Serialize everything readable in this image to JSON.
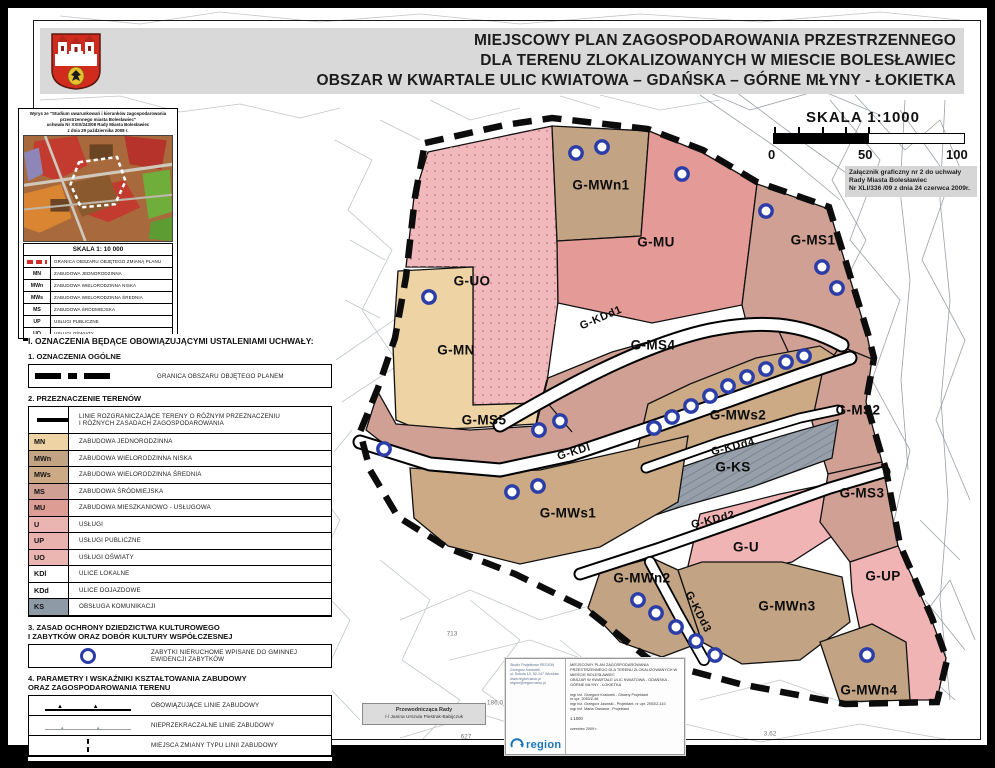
{
  "header": {
    "title_line1": "MIEJSCOWY PLAN ZAGOSPODAROWANIA PRZESTRZENNEGO",
    "title_line2": "DLA TERENU ZLOKALIZOWANYCH W MIESCIE BOLESŁAWIEC",
    "title_line3": "OBSZAR W KWARTALE ULIC KWIATOWA – GDAŃSKA – GÓRNE MŁYNY - ŁOKIETKA"
  },
  "scalebar": {
    "label": "SKALA 1:1000",
    "tick0": "0",
    "tick50": "50",
    "tick100": "100"
  },
  "attachment": {
    "line1": "Załącznik graficzny nr 2 do uchwały",
    "line2": "Rady Miasta Bolesławiec",
    "line3": "Nr XLI/336 /09 z dnia 24 czerwca 2009r."
  },
  "inset": {
    "header_lines": [
      "Wyrys ze \"Studium uwarunkowań i kierunków zagospodarowania",
      "przestrzennego  miasta Bolesławiec\"",
      "uchwała Nr XXIX/243/08 Rady Miasta Bolesławiec",
      "z dnia 29 października 2008 r."
    ],
    "scale_label": "SKALA 1: 10 000",
    "granica_label": "GRANICA OBSZARU OBJĘTEGO ZMIANĄ PLANU",
    "rows": [
      {
        "code": "MN",
        "label": "ZABUDOWA JEDNORODZINNA"
      },
      {
        "code": "MWn",
        "label": "ZABUDOWA WIELORODZINNA NISKA"
      },
      {
        "code": "MWs",
        "label": "ZABUDOWA WIELORODZINNA ŚREDNIA"
      },
      {
        "code": "MS",
        "label": "ZABUDOWA ŚRÓDMIEJSKA"
      },
      {
        "code": "UP",
        "label": "USŁUGI PUBLICZNE"
      },
      {
        "code": "UO",
        "label": "USŁUGI OŚWIATY"
      }
    ]
  },
  "legend": {
    "heading": "I. OZNACZENIA BĘDĄCE OBOWIĄZUJĄCYMI USTALENIAMI UCHWAŁY:",
    "s1": {
      "title": "1. OZNACZENIA OGÓLNE",
      "granica_label": "GRANICA OBSZARU OBJĘTEGO PLANEM"
    },
    "s2": {
      "title": "2. PRZEZNACZENIE TERENÓW",
      "line_row_l1": "LINIE ROZGRANICZAJĄCE TERENY O RÓŻNYM PRZEZNACZENIU",
      "line_row_l2": "I RÓŻNYCH ZASADACH ZAGOSPODAROWANIA",
      "zones": [
        {
          "code": "MN",
          "label": "ZABUDOWA JEDNORODZINNA",
          "color": "#eed3a4"
        },
        {
          "code": "MWn",
          "label": "ZABUDOWA WIELORODZINNA NISKA",
          "color": "#c2a485"
        },
        {
          "code": "MWs",
          "label": "ZABUDOWA WIELORODZINNA ŚREDNIA",
          "color": "#cbaa85"
        },
        {
          "code": "MS",
          "label": "ZABUDOWA ŚRÓDMIEJSKA",
          "color": "#d0a095"
        },
        {
          "code": "MU",
          "label": "ZABUDOWA MIESZKANIOWO - USŁUGOWA",
          "color": "#dd9d95"
        },
        {
          "code": "U",
          "label": "USŁUGI",
          "color": "#eab5b1"
        },
        {
          "code": "UP",
          "label": "USŁUGI PUBLICZNE",
          "color": "#e8b2ae"
        },
        {
          "code": "UO",
          "label": "USŁUGI OŚWIATY",
          "color": "#ebb6b2"
        },
        {
          "code": "KDl",
          "label": "ULICE LOKALNE",
          "color": "#ffffff"
        },
        {
          "code": "KDd",
          "label": "ULICE DOJAZDOWE",
          "color": "#ffffff"
        },
        {
          "code": "KS",
          "label": "OBSŁUGA KOMUNIKACJI",
          "color": "#8e9aa6"
        }
      ]
    },
    "s3": {
      "title_l1": "3. ZASAD OCHRONY DZIEDZICTWA KULTUROWEGO",
      "title_l2": "I ZABYTKÓW ORAZ DOBÓR KULTURY WSPÓŁCZESNEJ",
      "monument_label": "ZABYTKI NIERUCHOME WPISANE DO GMINNEJ EWIDENCJI ZABYTKÓW"
    },
    "s4": {
      "title_l1": "4. PARAMETRY I WSKAŹNIKI KSZTAŁTOWANIA ZABUDOWY",
      "title_l2": "ORAZ ZAGOSPODAROWANIA TERENU",
      "rows": [
        {
          "sym": "obligatory-building-line",
          "label": "OBOWIĄZUJĄCE LINIE ZABUDOWY"
        },
        {
          "sym": "max-building-line",
          "label": "NIEPRZEKRACZALNE LINIE ZABUDOWY"
        },
        {
          "sym": "line-type-change",
          "label": "MIEJSCA ZMIANY TYPU LINII ZABUDOWY"
        }
      ]
    }
  },
  "map": {
    "zones": [
      {
        "id": "G-UO",
        "x": 472,
        "y": 281
      },
      {
        "id": "G-MWn1",
        "x": 601,
        "y": 185
      },
      {
        "id": "G-MU",
        "x": 656,
        "y": 242
      },
      {
        "id": "G-MS1",
        "x": 813,
        "y": 240
      },
      {
        "id": "G-MN",
        "x": 456,
        "y": 350
      },
      {
        "id": "G-KDd1",
        "x": 601,
        "y": 318,
        "rot": -23,
        "cls": "road"
      },
      {
        "id": "G-MS4",
        "x": 653,
        "y": 345
      },
      {
        "id": "G-MS5",
        "x": 484,
        "y": 420
      },
      {
        "id": "G-MWs2",
        "x": 738,
        "y": 415
      },
      {
        "id": "G-MS2",
        "x": 858,
        "y": 410
      },
      {
        "id": "G-KDl",
        "x": 574,
        "y": 452,
        "rot": -17,
        "cls": "road"
      },
      {
        "id": "G-KDd4",
        "x": 733,
        "y": 447,
        "rot": -14,
        "cls": "road"
      },
      {
        "id": "G-KS",
        "x": 733,
        "y": 467
      },
      {
        "id": "G-MS3",
        "x": 862,
        "y": 493
      },
      {
        "id": "G-MWs1",
        "x": 568,
        "y": 513
      },
      {
        "id": "G-KDd2",
        "x": 713,
        "y": 520,
        "rot": -14,
        "cls": "road"
      },
      {
        "id": "G-U",
        "x": 746,
        "y": 547
      },
      {
        "id": "G-MWn2",
        "x": 642,
        "y": 578
      },
      {
        "id": "G-KDd3",
        "x": 698,
        "y": 612,
        "rot": 63,
        "cls": "road"
      },
      {
        "id": "G-MWn3",
        "x": 787,
        "y": 606
      },
      {
        "id": "G-UP",
        "x": 883,
        "y": 576
      },
      {
        "id": "G-MWn4",
        "x": 869,
        "y": 690
      }
    ],
    "monuments": [
      [
        576,
        153
      ],
      [
        602,
        147
      ],
      [
        682,
        174
      ],
      [
        766,
        211
      ],
      [
        822,
        267
      ],
      [
        837,
        288
      ],
      [
        429,
        297
      ],
      [
        384,
        449
      ],
      [
        539,
        430
      ],
      [
        560,
        421
      ],
      [
        512,
        492
      ],
      [
        538,
        486
      ],
      [
        654,
        428
      ],
      [
        672,
        417
      ],
      [
        691,
        406
      ],
      [
        710,
        396
      ],
      [
        728,
        386
      ],
      [
        747,
        377
      ],
      [
        766,
        369
      ],
      [
        786,
        362
      ],
      [
        804,
        356
      ],
      [
        638,
        600
      ],
      [
        656,
        613
      ],
      [
        676,
        627
      ],
      [
        696,
        641
      ],
      [
        715,
        655
      ],
      [
        867,
        655
      ]
    ],
    "annotations": [
      {
        "t": "713",
        "x": 452,
        "y": 634
      },
      {
        "t": "627",
        "x": 466,
        "y": 737
      },
      {
        "t": "186,0",
        "x": 495,
        "y": 703
      },
      {
        "t": "3,62",
        "x": 770,
        "y": 734
      }
    ]
  },
  "stamp": {
    "firm_lines": [
      "Studio Projektowe REGION",
      "Grzegorz Kosturek",
      "ul. Sokola 13, 52-147 Wrocław",
      "www.region.wroc.pl",
      "region@region.wroc.pl"
    ],
    "logo_text": "region",
    "title_lines": [
      "MIEJSCOWY PLAN ZAGOSPODAROWANIA",
      "PRZESTRZENNEGO DLA TERENU ZLOKALIZOWANYCH W",
      "MIEŚCIE BOLESŁAWIEC",
      "OBSZAR W KWARTALE ULIC KWIATOWA - GDAŃSKA -",
      "GÓRNE MŁYNY - ŁOKIETKA"
    ],
    "people_lines": [
      "mgr inż. Grzegorz Kosturek - Główny Projektant",
      "nr upr. 2053/Z-48",
      "mgr inż. Grzegorz Jasinski - Projektant, nr upr. 2053/Z-410",
      "mgr inż. Marta Owsiana - Projektant"
    ],
    "scale_line": "1:1000",
    "date_line": "czerwiec 2009 r."
  },
  "chairwoman": {
    "line1": "Przewodnicząca Rady",
    "line2": "/-/ Janina Urszula Piestrak-Babijczuk"
  }
}
